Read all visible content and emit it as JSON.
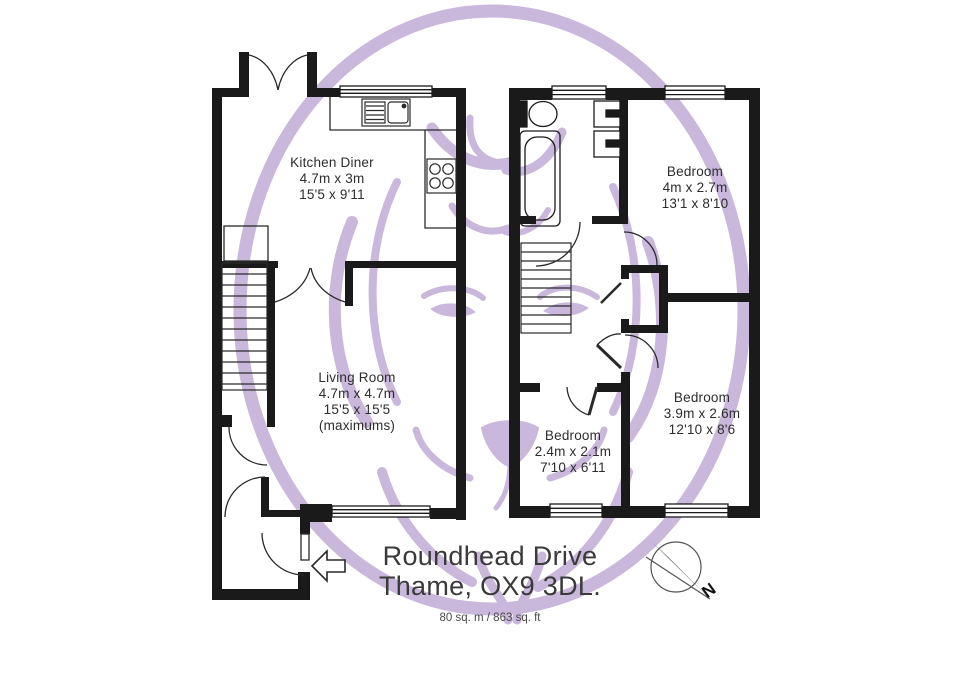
{
  "plan": {
    "title_line1": "Roundhead Drive",
    "title_line2": "Thame, OX9 3DL.",
    "total_area": "80 sq. m / 863 sq. ft",
    "compass": {
      "label": "N"
    }
  },
  "rooms": [
    {
      "id": "kitchen-diner",
      "name": "Kitchen Diner",
      "metric": "4.7m x 3m",
      "imperial": "15'5 x 9'11"
    },
    {
      "id": "living-room",
      "name": "Living Room",
      "metric": "4.7m x 4.7m",
      "imperial": "15'5 x 15'5",
      "note": "(maximums)"
    },
    {
      "id": "bedroom-1",
      "name": "Bedroom",
      "metric": "4m x 2.7m",
      "imperial": "13'1 x 8'10"
    },
    {
      "id": "bedroom-2",
      "name": "Bedroom",
      "metric": "3.9m x 2.6m",
      "imperial": "12'10 x 8'6"
    },
    {
      "id": "bedroom-3",
      "name": "Bedroom",
      "metric": "2.4m x 2.1m",
      "imperial": "7'10 x 6'11"
    }
  ],
  "icons": {
    "watermark": "lion-crest",
    "compass": "north-arrow",
    "entry": "entry-arrow"
  },
  "colors": {
    "wall": "#1a1a1a",
    "watermark_purple": "#c9b7dc",
    "label_text": "#2d2d2d",
    "title_text": "#3a3a3a"
  }
}
